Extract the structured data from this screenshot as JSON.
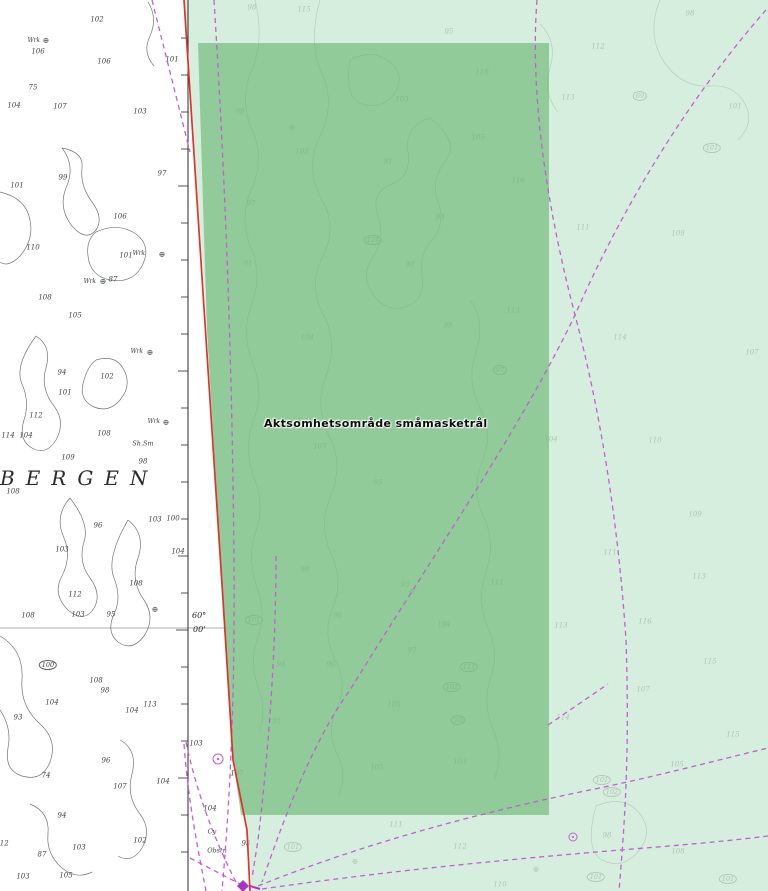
{
  "map": {
    "place_label": "BERGEN",
    "area_label": "Aktsomhetsområde småmasketrål",
    "latitude_labels": {
      "degrees": "60°",
      "minutes": "00'"
    },
    "text_labels": {
      "wreck": "Wrk",
      "obstruction": "Obstn",
      "seabed_shells": "Sh.Sm",
      "seabed_clay": "Cy"
    },
    "colors": {
      "precaution_area_dark": "#86c58d",
      "precaution_area_light": "#d8efdd",
      "boundary_red": "#e03228",
      "route_magenta": "#c35fd0",
      "contour_gray": "#70786e",
      "ink": "#3d4440"
    },
    "soundings_white_area": [
      [
        97,
        20,
        "102"
      ],
      [
        172,
        60,
        "101"
      ],
      [
        38,
        52,
        "106"
      ],
      [
        104,
        62,
        "106"
      ],
      [
        33,
        88,
        "75"
      ],
      [
        14,
        106,
        "104"
      ],
      [
        60,
        107,
        "107"
      ],
      [
        140,
        112,
        "103"
      ],
      [
        17,
        186,
        "101"
      ],
      [
        63,
        178,
        "99"
      ],
      [
        162,
        174,
        "97"
      ],
      [
        120,
        217,
        "106"
      ],
      [
        33,
        248,
        "110"
      ],
      [
        126,
        256,
        "101"
      ],
      [
        113,
        280,
        "87"
      ],
      [
        45,
        298,
        "108"
      ],
      [
        75,
        316,
        "105"
      ],
      [
        62,
        373,
        "94"
      ],
      [
        107,
        377,
        "102"
      ],
      [
        65,
        393,
        "101"
      ],
      [
        36,
        416,
        "112"
      ],
      [
        8,
        436,
        "114"
      ],
      [
        26,
        436,
        "104"
      ],
      [
        104,
        434,
        "108"
      ],
      [
        68,
        458,
        "109"
      ],
      [
        143,
        462,
        "98"
      ],
      [
        13,
        492,
        "108"
      ],
      [
        98,
        526,
        "96"
      ],
      [
        155,
        520,
        "103"
      ],
      [
        173,
        519,
        "100"
      ],
      [
        62,
        550,
        "103"
      ],
      [
        178,
        552,
        "104"
      ],
      [
        75,
        595,
        "112"
      ],
      [
        136,
        584,
        "108"
      ],
      [
        28,
        616,
        "108"
      ],
      [
        78,
        615,
        "103"
      ],
      [
        111,
        615,
        "95"
      ],
      [
        96,
        681,
        "108"
      ],
      [
        52,
        703,
        "104"
      ],
      [
        18,
        718,
        "93"
      ],
      [
        105,
        691,
        "98"
      ],
      [
        150,
        705,
        "113"
      ],
      [
        132,
        711,
        "104"
      ],
      [
        106,
        761,
        "96"
      ],
      [
        46,
        776,
        "74"
      ],
      [
        120,
        787,
        "107"
      ],
      [
        163,
        782,
        "104"
      ],
      [
        62,
        816,
        "94"
      ],
      [
        2,
        844,
        "112"
      ],
      [
        79,
        848,
        "103"
      ],
      [
        42,
        855,
        "87"
      ],
      [
        140,
        841,
        "102"
      ],
      [
        23,
        877,
        "103"
      ],
      [
        66,
        876,
        "105"
      ],
      [
        237,
        774,
        "107"
      ],
      [
        210,
        809,
        "104"
      ],
      [
        246,
        844,
        "93"
      ],
      [
        196,
        744,
        "103"
      ]
    ],
    "soundings_dark_green": [
      [
        252,
        8,
        "98"
      ],
      [
        304,
        10,
        "115"
      ],
      [
        449,
        32,
        "95"
      ],
      [
        240,
        112,
        "99"
      ],
      [
        402,
        100,
        "103"
      ],
      [
        482,
        73,
        "110"
      ],
      [
        302,
        152,
        "102"
      ],
      [
        388,
        162,
        "91"
      ],
      [
        478,
        138,
        "105"
      ],
      [
        251,
        204,
        "97"
      ],
      [
        518,
        181,
        "116"
      ],
      [
        440,
        218,
        "93"
      ],
      [
        248,
        264,
        "91"
      ],
      [
        410,
        265,
        "90"
      ],
      [
        448,
        326,
        "99"
      ],
      [
        307,
        338,
        "108"
      ],
      [
        513,
        311,
        "113"
      ],
      [
        320,
        447,
        "107"
      ],
      [
        378,
        483,
        "95"
      ],
      [
        305,
        570,
        "98"
      ],
      [
        338,
        616,
        "96"
      ],
      [
        497,
        583,
        "111"
      ],
      [
        444,
        625,
        "104"
      ],
      [
        412,
        651,
        "97"
      ],
      [
        281,
        665,
        "98"
      ],
      [
        331,
        665,
        "96"
      ],
      [
        394,
        705,
        "105"
      ],
      [
        277,
        722,
        "91"
      ],
      [
        377,
        768,
        "105"
      ],
      [
        460,
        762,
        "103"
      ],
      [
        405,
        585,
        "93"
      ]
    ],
    "soundings_light_green": [
      [
        690,
        14,
        "98"
      ],
      [
        598,
        47,
        "112"
      ],
      [
        568,
        98,
        "113"
      ],
      [
        735,
        107,
        "101"
      ],
      [
        583,
        228,
        "111"
      ],
      [
        678,
        234,
        "109"
      ],
      [
        620,
        338,
        "114"
      ],
      [
        752,
        353,
        "107"
      ],
      [
        551,
        440,
        "104"
      ],
      [
        655,
        441,
        "110"
      ],
      [
        695,
        515,
        "109"
      ],
      [
        610,
        553,
        "111"
      ],
      [
        699,
        577,
        "113"
      ],
      [
        561,
        626,
        "113"
      ],
      [
        645,
        622,
        "116"
      ],
      [
        710,
        662,
        "115"
      ],
      [
        643,
        690,
        "107"
      ],
      [
        563,
        718,
        "114"
      ],
      [
        733,
        735,
        "115"
      ],
      [
        677,
        765,
        "105"
      ],
      [
        607,
        836,
        "98"
      ],
      [
        678,
        852,
        "108"
      ],
      [
        396,
        825,
        "111"
      ],
      [
        460,
        847,
        "112"
      ],
      [
        500,
        885,
        "110"
      ]
    ],
    "circled_soundings": [
      [
        48,
        665,
        "100"
      ],
      [
        373,
        240,
        "124"
      ],
      [
        500,
        370,
        "97"
      ],
      [
        254,
        620,
        "101"
      ],
      [
        469,
        667,
        "121"
      ],
      [
        452,
        687,
        "102"
      ],
      [
        458,
        720,
        "93"
      ],
      [
        640,
        96,
        "69"
      ],
      [
        712,
        148,
        "101"
      ],
      [
        602,
        780,
        "101"
      ],
      [
        612,
        792,
        "102"
      ],
      [
        596,
        877,
        "101"
      ],
      [
        728,
        879,
        "101"
      ],
      [
        293,
        847,
        "101"
      ]
    ],
    "wreck_symbols": [
      [
        46,
        41
      ],
      [
        103,
        282
      ],
      [
        162,
        255
      ],
      [
        150,
        353
      ],
      [
        166,
        423
      ],
      [
        155,
        610
      ],
      [
        292,
        128
      ],
      [
        355,
        862
      ],
      [
        536,
        870
      ],
      [
        412,
        592
      ]
    ],
    "wreck_label_positions": [
      [
        40,
        41
      ],
      [
        96,
        282
      ],
      [
        145,
        254
      ],
      [
        143,
        352
      ],
      [
        160,
        422
      ]
    ],
    "seabed_note_positions": {
      "shells": [
        143,
        444
      ],
      "clay": [
        212,
        832
      ]
    },
    "obstruction_position": [
      217,
      851
    ]
  }
}
